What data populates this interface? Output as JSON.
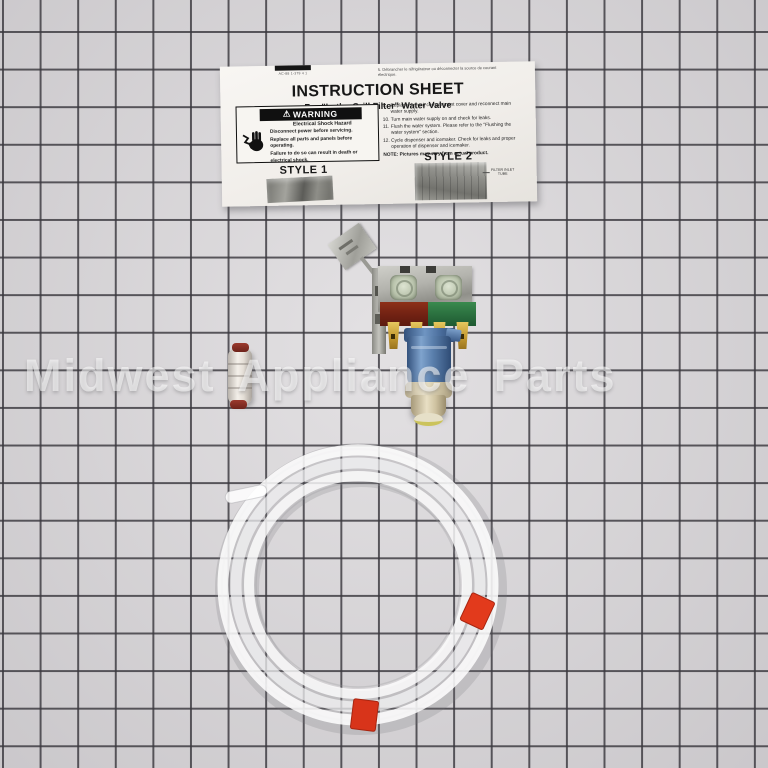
{
  "photo": {
    "watermark": "Midwest Appliance Parts"
  },
  "instruction_sheet": {
    "top_bar_code": "AC-88 1-379 4 1",
    "top_right_note": "5. Débrancher le réfrigérateur ou déconnecter la source de courant\nélectrique.",
    "title": "INSTRUCTION SHEET",
    "subtitle": "For \"In the Grill Filter\" Water Valve",
    "warning": {
      "symbol": "⚠",
      "header": "WARNING",
      "hazard": "Electrical Shock Hazard",
      "line1": "Disconnect power before servicing.",
      "line2": "Replace all parts and panels before operating.",
      "line3": "Failure to do so can result in death or electrical shock."
    },
    "style1_label": "STYLE 1",
    "style2_label": "STYLE 2",
    "style2_callout": "FILTER INLET\nTUBE",
    "steps": [
      {
        "num": "9.",
        "text": "Replace the unit compartment cover and reconnect main water supply."
      },
      {
        "num": "10.",
        "text": "Turn main water supply on and check for leaks."
      },
      {
        "num": "11.",
        "text": "Flush the water system. Please refer to the \"Flushing the water system\" section."
      },
      {
        "num": "12.",
        "text": "Cycle dispenser and icemaker. Check for leaks and proper operation of dispenser and icemaker."
      }
    ],
    "note": "NOTE: Pictures may vary from actual product."
  },
  "parts": {
    "valve": "dual-solenoid water inlet valve with mounting bracket",
    "coupling": "quick-connect union coupling",
    "tubing": "coiled translucent water supply tubing with red tape bands"
  },
  "colors": {
    "background": "#d7d4d7",
    "grid_line": "#3a383e",
    "tape_red": "#e23a1c",
    "valve_blue": "#5b80ad",
    "bobbin_red": "#702113",
    "bobbin_green": "#2a6e3e",
    "brass": "#c49a32",
    "fitting_cream": "#d6cbab"
  },
  "icons": {
    "electrical_shock_icon": "hand-with-electric-shock",
    "warning_triangle_icon": "⚠"
  }
}
